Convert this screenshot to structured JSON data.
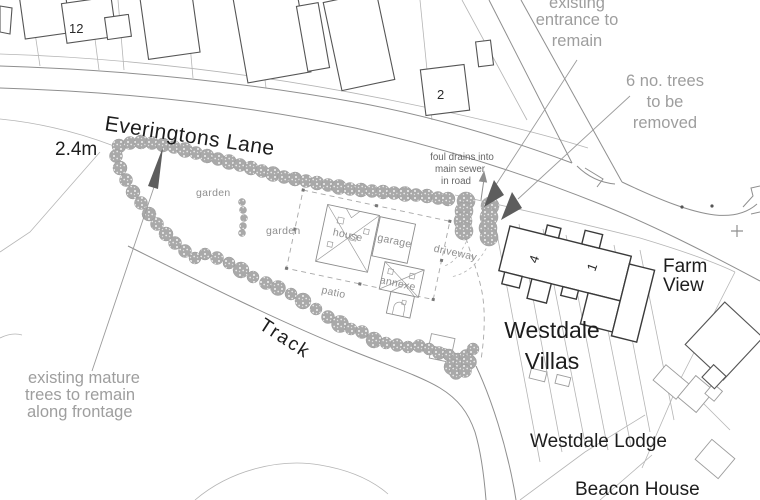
{
  "drawing": {
    "roads": {
      "everingtons_lane": "Everingtons Lane",
      "track": "Track"
    },
    "properties": {
      "westdale_villas_line1": "Westdale",
      "westdale_villas_line2": "Villas",
      "farm_view_line1": "Farm",
      "farm_view_line2": "View",
      "westdale_lodge": "Westdale Lodge",
      "beacon_house": "Beacon House"
    },
    "plot_numbers": {
      "no_12": "12",
      "no_2": "2",
      "villa_4": "4",
      "villa_1": "1"
    },
    "site_labels": {
      "garden_west": "garden",
      "garden_east": "garden",
      "house": "house",
      "garage": "garage",
      "annexe": "annexe",
      "patio": "patio",
      "driveway": "driveway"
    },
    "annotations": {
      "dimension": "2.4m",
      "entrance_note_line1": "existing",
      "entrance_note_line2": "entrance to",
      "entrance_note_line3": "remain",
      "trees_removed_note_line1": "6 no. trees",
      "trees_removed_note_line2": "to be",
      "trees_removed_note_line3": "removed",
      "foul_drains_note_line1": "foul drains into",
      "foul_drains_note_line2": "main sewer",
      "foul_drains_note_line3": "in road",
      "mature_trees_note_line1": "existing mature",
      "mature_trees_note_line2": "trees to remain",
      "mature_trees_note_line3": "along frontage"
    },
    "colors": {
      "background": "#ffffff",
      "parcel_line": "#b5b5b5",
      "road_line": "#8f8f8f",
      "building_dark": "#3a3a3a",
      "building_light": "#9c9c9c",
      "tree_fill": "#a9a9a9",
      "arrow_fill": "#5d5d5d",
      "annotation_text": "#9e9e9e",
      "label_text": "#1d1d1d",
      "small_note_text": "#666666"
    }
  }
}
